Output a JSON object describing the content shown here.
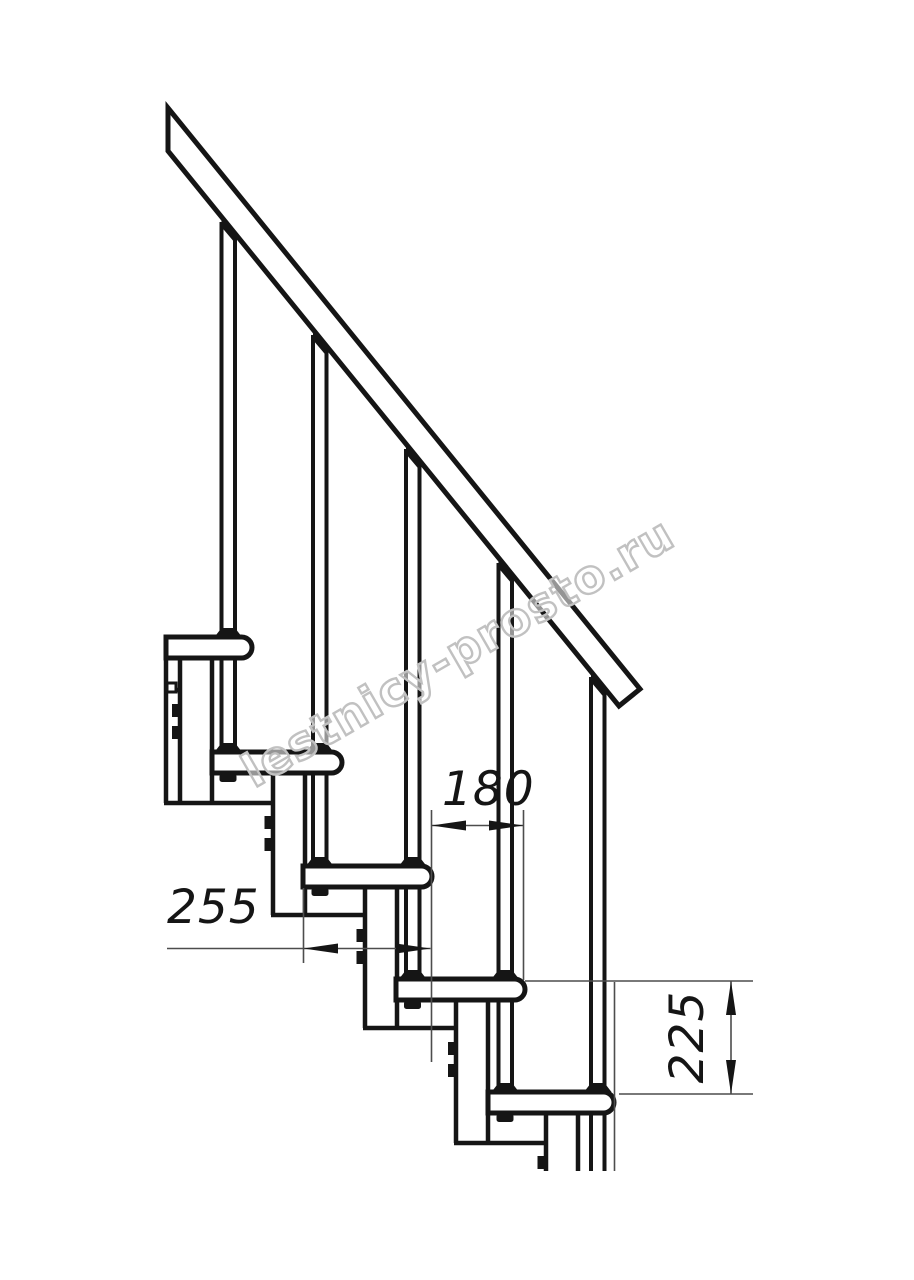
{
  "drawing": {
    "title": "Modular staircase side-view technical drawing",
    "watermark": {
      "text": "lestnicy-prosto.ru",
      "color": "#c1c1c1"
    },
    "dimensions": {
      "tread_depth": "255",
      "step_run": "180",
      "step_rise": "225"
    },
    "colors": {
      "line": "#151515",
      "thin_line": "#4d4d4d",
      "background": "#ffffff",
      "watermark": "#c1c1c1"
    },
    "structure": {
      "treads_visible": 5,
      "balusters_visible": 5,
      "support_columns_visible": 5,
      "handrail": "diagonal band, cut at left edge, free end lower right",
      "fasteners": "clamp tabs on column sides, flange collars on treads, nuts under treads"
    }
  }
}
